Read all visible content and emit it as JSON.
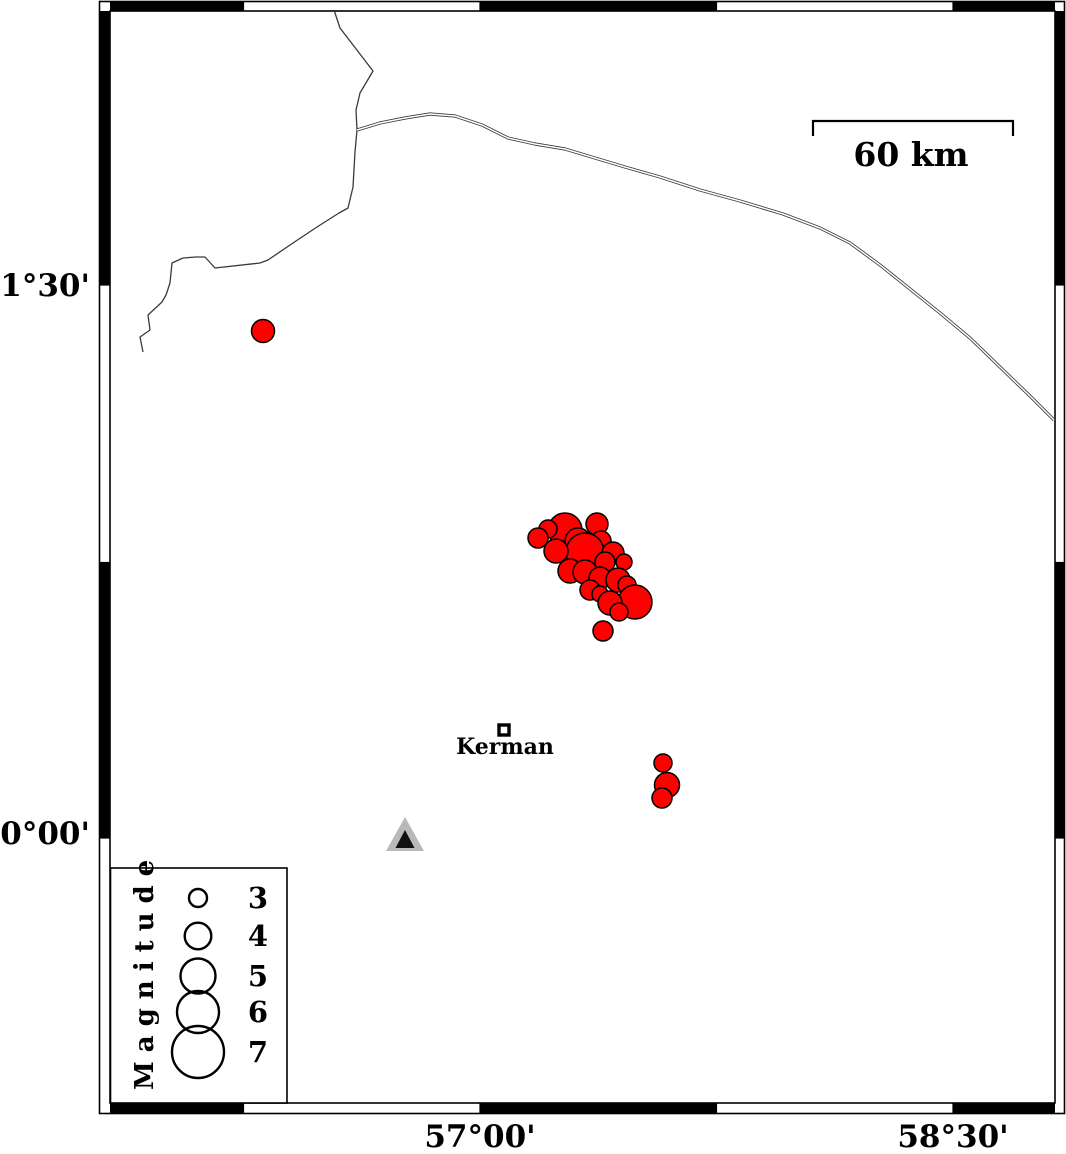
{
  "map": {
    "title": "Kerman region earthquake epicenter map",
    "colors": {
      "background": "#ffffff",
      "frame_black": "#000000",
      "quake_fill": "#ff0000",
      "quake_stroke": "#000000",
      "station_outer": "#b9b9b9",
      "station_inner": "#111111",
      "line": "#3a3a3a"
    },
    "frame": {
      "outer": {
        "x": 99.5,
        "y": 1.5,
        "w": 965,
        "h": 1112
      },
      "inner": {
        "x": 110,
        "y": 11,
        "w": 945,
        "h": 1092
      },
      "x_bounds": [
        110,
        243.5,
        480,
        716.5,
        953,
        1055
      ],
      "x_fill": [
        "black",
        "white",
        "black",
        "white",
        "black"
      ],
      "y_bounds": [
        11,
        285,
        562.5,
        838,
        1103
      ],
      "y_fill": [
        "black",
        "white",
        "black",
        "white"
      ]
    },
    "axis_labels": {
      "left": [
        {
          "text": "31°30'",
          "x": 90,
          "y": 296
        },
        {
          "text": "30°00'",
          "x": 90,
          "y": 844
        }
      ],
      "bottom": [
        {
          "text": "57°00'",
          "x": 480,
          "y": 1147
        },
        {
          "text": "58°30'",
          "x": 953,
          "y": 1147
        }
      ]
    },
    "scale_bar": {
      "label": "60 km",
      "x1": 813,
      "x2": 1013,
      "y": 121,
      "tick_len": 15,
      "label_x": 911,
      "label_y": 166
    },
    "city": {
      "name": "Kerman",
      "x": 504,
      "y": 730,
      "size": 10,
      "label_x": 505,
      "label_y": 754
    },
    "station": {
      "outer": [
        [
          405,
          817
        ],
        [
          386,
          851
        ],
        [
          424,
          851
        ]
      ],
      "inner": [
        [
          405,
          830
        ],
        [
          395.5,
          848
        ],
        [
          414.5,
          848
        ]
      ]
    },
    "earthquakes": [
      {
        "x": 263,
        "y": 331,
        "r": 11.5
      },
      {
        "x": 565,
        "y": 530,
        "r": 17
      },
      {
        "x": 548,
        "y": 529,
        "r": 9
      },
      {
        "x": 538,
        "y": 538,
        "r": 10
      },
      {
        "x": 597,
        "y": 524,
        "r": 11
      },
      {
        "x": 578,
        "y": 541,
        "r": 13
      },
      {
        "x": 601,
        "y": 541,
        "r": 10
      },
      {
        "x": 585,
        "y": 552,
        "r": 19
      },
      {
        "x": 556,
        "y": 551,
        "r": 12
      },
      {
        "x": 613,
        "y": 553,
        "r": 11
      },
      {
        "x": 605,
        "y": 562,
        "r": 10
      },
      {
        "x": 624,
        "y": 562,
        "r": 8
      },
      {
        "x": 570,
        "y": 571,
        "r": 12
      },
      {
        "x": 585,
        "y": 572,
        "r": 12
      },
      {
        "x": 600,
        "y": 578,
        "r": 11
      },
      {
        "x": 618,
        "y": 580,
        "r": 12
      },
      {
        "x": 627,
        "y": 585,
        "r": 9
      },
      {
        "x": 590,
        "y": 590,
        "r": 10
      },
      {
        "x": 600,
        "y": 594,
        "r": 8
      },
      {
        "x": 635,
        "y": 602,
        "r": 17
      },
      {
        "x": 610,
        "y": 603,
        "r": 12
      },
      {
        "x": 619,
        "y": 612,
        "r": 9
      },
      {
        "x": 603,
        "y": 631,
        "r": 10
      },
      {
        "x": 663,
        "y": 763,
        "r": 9
      },
      {
        "x": 667,
        "y": 785,
        "r": 12.5
      },
      {
        "x": 662,
        "y": 798,
        "r": 10
      }
    ],
    "lines": {
      "boundary": [
        [
          334,
          10
        ],
        [
          340,
          28
        ],
        [
          373,
          71
        ],
        [
          360,
          93
        ],
        [
          356,
          110
        ],
        [
          357,
          130
        ],
        [
          355,
          152
        ],
        [
          353,
          187
        ],
        [
          348,
          208
        ],
        [
          339,
          213
        ],
        [
          317,
          227
        ],
        [
          293,
          243
        ],
        [
          268,
          260
        ],
        [
          260,
          263
        ],
        [
          215,
          268
        ],
        [
          205,
          257
        ],
        [
          196,
          257
        ],
        [
          183,
          258
        ],
        [
          172,
          263
        ],
        [
          170,
          283
        ],
        [
          166,
          295
        ],
        [
          162,
          302
        ],
        [
          148,
          315
        ],
        [
          150,
          330
        ],
        [
          140,
          337
        ],
        [
          143,
          352
        ]
      ],
      "river": [
        [
          357,
          130
        ],
        [
          380,
          123
        ],
        [
          405,
          118
        ],
        [
          430,
          114
        ],
        [
          455,
          116
        ],
        [
          482,
          125
        ],
        [
          508,
          138
        ],
        [
          535,
          144
        ],
        [
          565,
          149
        ],
        [
          595,
          158
        ],
        [
          625,
          167
        ],
        [
          660,
          177
        ],
        [
          700,
          190
        ],
        [
          740,
          201
        ],
        [
          783,
          214
        ],
        [
          820,
          228
        ],
        [
          850,
          243
        ],
        [
          880,
          265
        ],
        [
          910,
          289
        ],
        [
          940,
          313
        ],
        [
          970,
          338
        ],
        [
          1000,
          367
        ],
        [
          1030,
          396
        ],
        [
          1054,
          420
        ]
      ]
    },
    "legend": {
      "title": "Magnitude",
      "box": {
        "x": 110.5,
        "y": 868,
        "w": 176.5,
        "h": 235
      },
      "circle_cx": 198,
      "label_x": 258,
      "items": [
        {
          "label": "3",
          "cy": 898,
          "r": 9
        },
        {
          "label": "4",
          "cy": 936,
          "r": 13.3
        },
        {
          "label": "5",
          "cy": 976,
          "r": 17.5
        },
        {
          "label": "6",
          "cy": 1012,
          "r": 21
        },
        {
          "label": "7",
          "cy": 1052,
          "r": 26
        }
      ]
    }
  }
}
